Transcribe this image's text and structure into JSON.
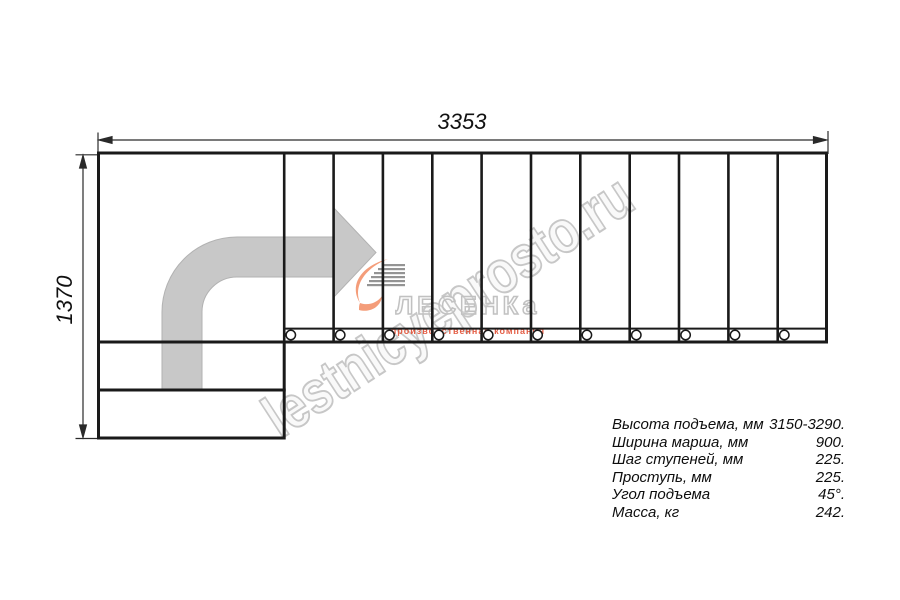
{
  "page": {
    "background": "#ffffff"
  },
  "drawing": {
    "width_dimension": "3353",
    "height_dimension": "1370",
    "step_count": 11,
    "bolt_count": 11,
    "line_color": "#1a1a1a",
    "arrow_color": "#c8c8c8"
  },
  "watermark": {
    "text": "lestnicyeprosto.ru",
    "color": "#c7c7c7"
  },
  "logo": {
    "name": "ЛЕСЕНКа",
    "tagline": "производственная компания",
    "flame_color": "#f49d7a",
    "dash_color": "#828282",
    "tagline_color": "#e14a2e"
  },
  "specs": {
    "rows": [
      {
        "label": "Высота подъема, мм",
        "value": "3150-3290."
      },
      {
        "label": "Ширина марша, мм",
        "value": "900."
      },
      {
        "label": "Шаг ступеней, мм",
        "value": "225."
      },
      {
        "label": "Проступь, мм",
        "value": "225."
      },
      {
        "label": "Угол подъема",
        "value": "45°."
      },
      {
        "label": "Масса, кг",
        "value": "242."
      }
    ]
  }
}
